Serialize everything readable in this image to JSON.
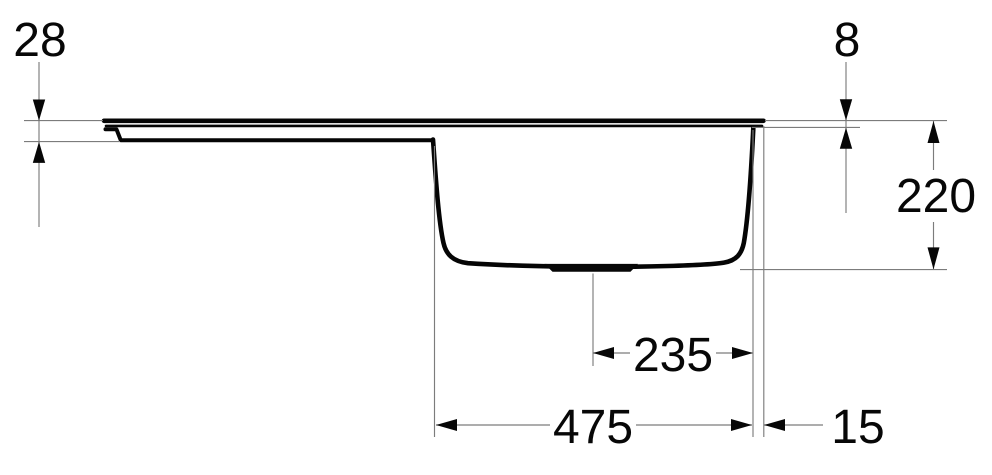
{
  "drawing": {
    "title": "sink-side-elevation-dimension-drawing",
    "background": "#ffffff",
    "profile_color": "#050505",
    "dimension_line_color": "#7c7c7c",
    "text_color": "#070707",
    "dimensions": {
      "left_edge_thickness": {
        "value": "28"
      },
      "rim_thickness": {
        "value": "8"
      },
      "bowl_depth": {
        "value": "220"
      },
      "drain_to_wall": {
        "value": "235"
      },
      "bowl_width": {
        "value": "475"
      },
      "right_overhang": {
        "value": "15"
      }
    }
  }
}
